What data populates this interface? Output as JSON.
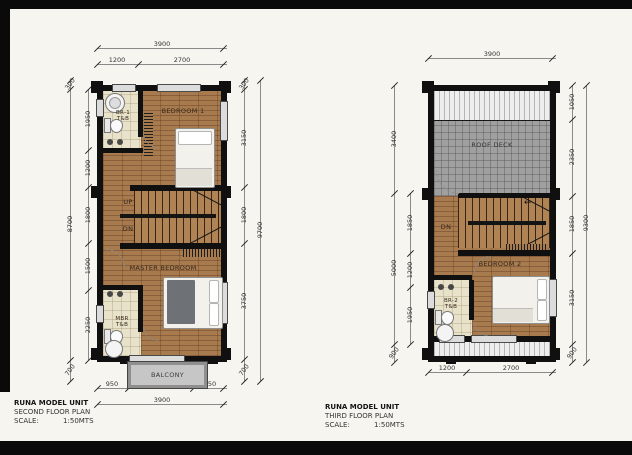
{
  "plan1": {
    "title": "RUNA MODEL UNIT",
    "subtitle": "SECOND FLOOR PLAN",
    "scale_label": "SCALE:",
    "scale_value": "1:50MTS",
    "labels": {
      "bedroom1": "BEDROOM 1",
      "br1_tb": "BR-1 T&B",
      "master_bedroom": "MASTER BEDROOM",
      "mbr_tb": "MBR T&B",
      "balcony": "BALCONY",
      "up": "UP",
      "dn": "DN"
    },
    "dims": {
      "top_total": "3900",
      "top": [
        "1200",
        "2700"
      ],
      "bottom": [
        "950",
        "2000",
        "950"
      ],
      "bottom_total": "3900",
      "left_inner": [
        "1950",
        "1200",
        "1800",
        "1500",
        "2250"
      ],
      "left_outer": [
        "300",
        "8700",
        "700"
      ],
      "right_inner": [
        "300",
        "3150",
        "1800",
        "3750",
        "700"
      ],
      "right_total": "9700"
    }
  },
  "plan2": {
    "title": "RUNA MODEL UNIT",
    "subtitle": "THIRD FLOOR PLAN",
    "scale_label": "SCALE:",
    "scale_value": "1:50MTS",
    "labels": {
      "roof_deck": "ROOF DECK",
      "bedroom2": "BEDROOM 2",
      "br2_tb": "BR-2 T&B",
      "dn": "DN"
    },
    "icons": {
      "stair_arrow": "←"
    },
    "dims": {
      "top_total": "3900",
      "bottom": [
        "1200",
        "2700"
      ],
      "left_inner": [
        "1850",
        "1200",
        "1950"
      ],
      "left_outer": [
        "3400",
        "5000",
        "900"
      ],
      "right_inner": [
        "1050",
        "2350",
        "1850",
        "3150",
        "900"
      ],
      "right_total": "9300"
    }
  },
  "colors": {
    "wall": "#101010",
    "wood_floor": "#a87b4f",
    "bath_tile": "#e9e2ca",
    "roof_deck": "#a0a0a0",
    "balcony": "#c6c6c6",
    "frame": "#0a0a0a"
  }
}
